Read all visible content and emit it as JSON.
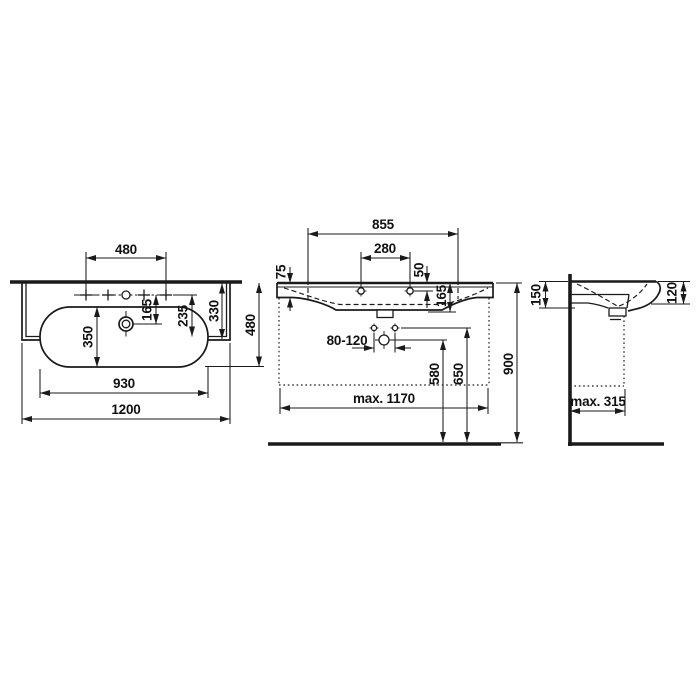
{
  "colors": {
    "line": "#1a1a1a",
    "background": "#ffffff"
  },
  "views": {
    "plan": {
      "dims": {
        "tap_spacing": "480",
        "tap_to_drain": "165",
        "tap_to_front": "235",
        "ledge_depth": "330",
        "overall_depth": "480",
        "bowl_depth": "350",
        "bowl_width": "930",
        "overall_width": "1200"
      }
    },
    "front": {
      "dims": {
        "tap_span": "855",
        "fixing_span": "280",
        "rim_thickness": "75",
        "tap_offset": "50",
        "outlet_depth": "165",
        "fixing_range": "80-120",
        "trap_height": "580",
        "fixing_height": "650",
        "rim_height": "900",
        "max_furniture_width": "max. 1170"
      }
    },
    "side": {
      "dims": {
        "back_height": "150",
        "front_height": "120",
        "max_furniture_depth": "max. 315"
      }
    }
  }
}
